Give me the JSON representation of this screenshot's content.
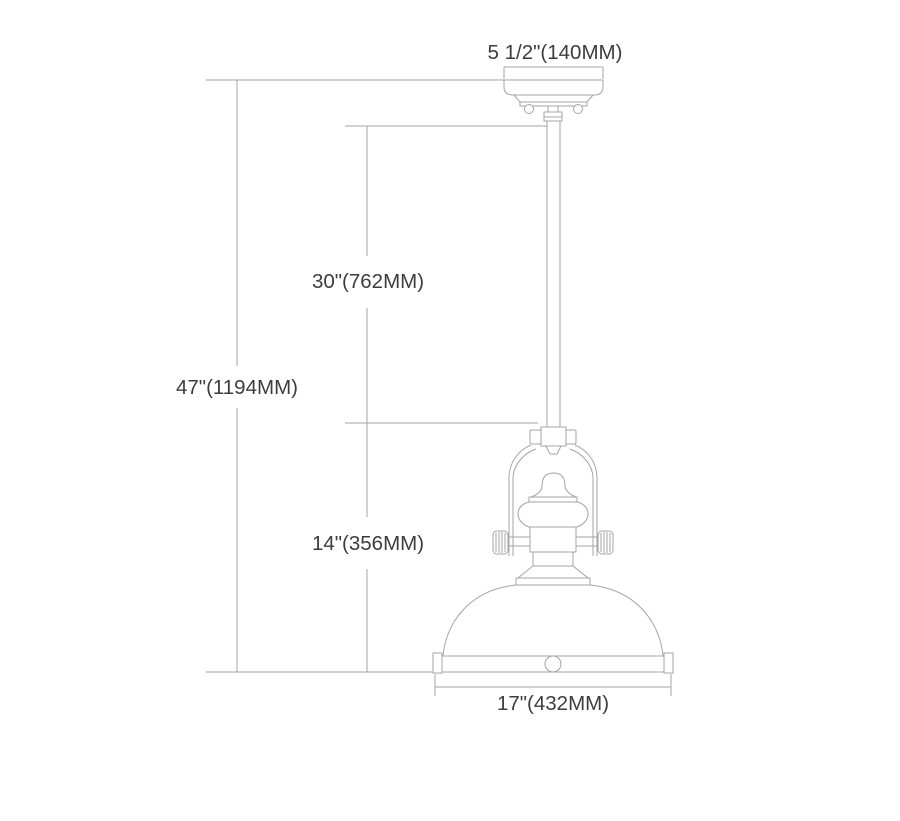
{
  "diagram": {
    "type": "technical-dimension-drawing",
    "subject": "single-light pendant fixture with rod, yoke and dome shade",
    "labels": {
      "canopy_width": "5 1/2\"(140MM)",
      "rod_length": "30\"(762MM)",
      "overall_height": "47\"(1194MM)",
      "fixture_height": "14\"(356MM)",
      "shade_diameter": "17\"(432MM)"
    },
    "colors": {
      "line": "#a4a4a4",
      "text": "#3d3d3d",
      "background": "#ffffff"
    }
  }
}
